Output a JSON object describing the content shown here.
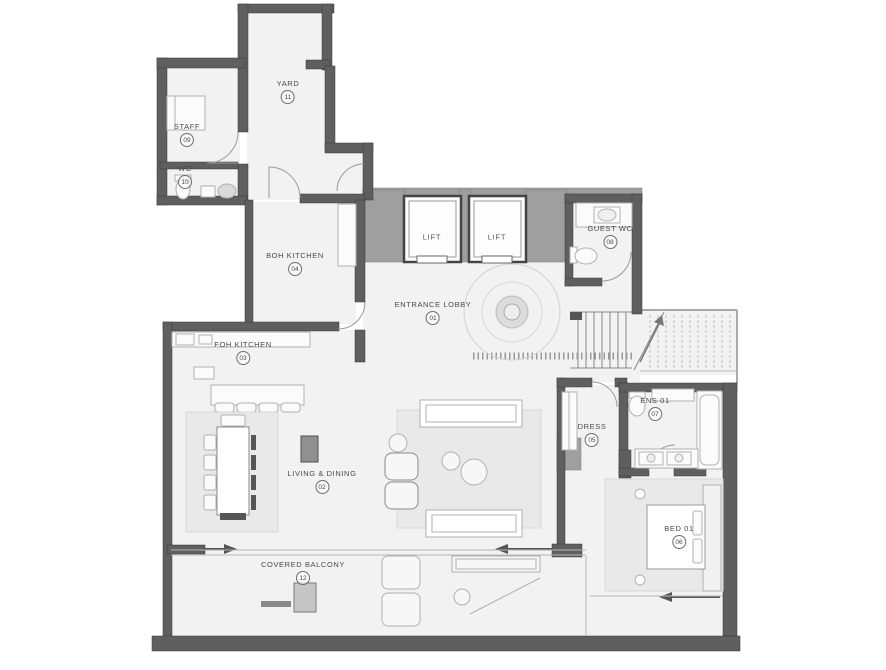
{
  "document": {
    "type": "architectural floor plan",
    "description": "Apartment floor plan with entrance lobby, lifts, kitchens, living/dining, bedroom suite, service rooms and covered balcony"
  },
  "colors": {
    "wall": "#5f5f5f",
    "wall_light": "#9f9f9f",
    "floor": "#f2f2f2",
    "furniture_line": "#b0b0b0",
    "rug": "#e9e9e9",
    "label_text": "#4a4a4a"
  },
  "rooms": [
    {
      "id": "entrance-lobby",
      "name": "ENTRANCE LOBBY",
      "number": "01"
    },
    {
      "id": "living-dining",
      "name": "LIVING & DINING",
      "number": "02"
    },
    {
      "id": "foh-kitchen",
      "name": "FOH KITCHEN",
      "number": "03"
    },
    {
      "id": "boh-kitchen",
      "name": "BOH KITCHEN",
      "number": "04"
    },
    {
      "id": "dress",
      "name": "DRESS",
      "number": "05"
    },
    {
      "id": "bed-01",
      "name": "BED 01",
      "number": "06"
    },
    {
      "id": "ens-01",
      "name": "ENS 01",
      "number": "07"
    },
    {
      "id": "guest-wc",
      "name": "GUEST WC",
      "number": "08"
    },
    {
      "id": "staff",
      "name": "STAFF",
      "number": "09"
    },
    {
      "id": "wc",
      "name": "WC",
      "number": "10"
    },
    {
      "id": "yard",
      "name": "YARD",
      "number": "11"
    },
    {
      "id": "covered-balcony",
      "name": "COVERED BALCONY",
      "number": "12"
    }
  ],
  "lifts": [
    {
      "name": "LIFT"
    },
    {
      "name": "LIFT"
    }
  ]
}
